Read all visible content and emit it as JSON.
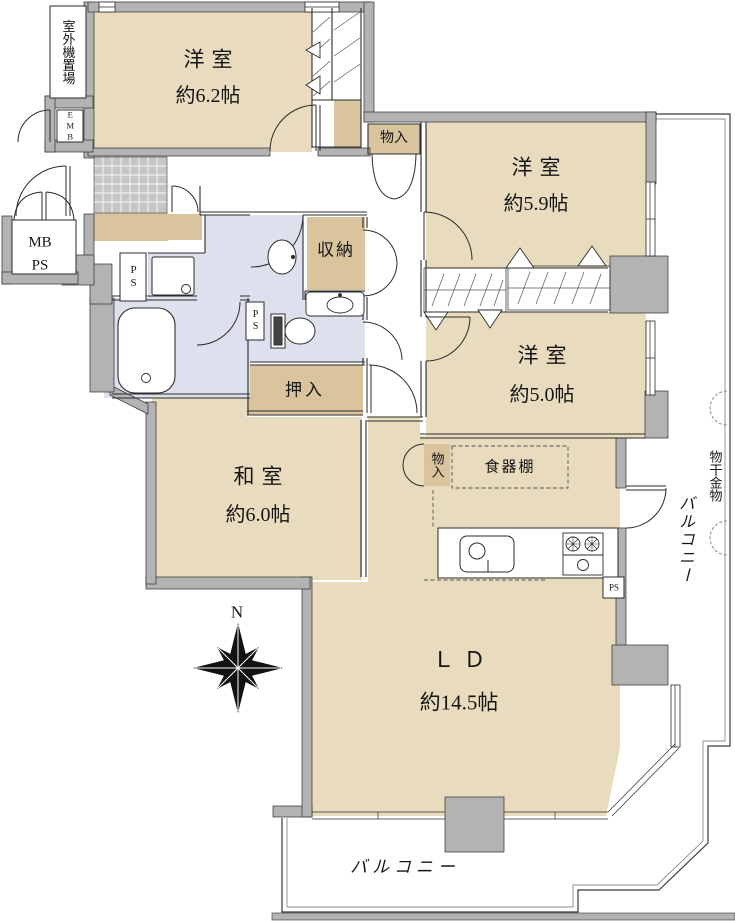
{
  "colors": {
    "room_tan": "#e9dcbe",
    "closet_tan": "#d9c49e",
    "wet_blue": "#dde1ee",
    "wall_gray": "#b3b3b3",
    "tile_gray": "#c6c6c6",
    "line": "#2b2b2b"
  },
  "compass": {
    "north_label": "N"
  },
  "rooms": {
    "western_6_2": {
      "name": "洋室",
      "size": "約6.2帖"
    },
    "western_5_9": {
      "name": "洋室",
      "size": "約5.9帖"
    },
    "western_5_0": {
      "name": "洋室",
      "size": "約5.0帖"
    },
    "japanese_6_0": {
      "name": "和室",
      "size": "約6.0帖"
    },
    "living_dining": {
      "name": "ＬＤ",
      "size": "約14.5帖"
    }
  },
  "storage": {
    "shuno": "収納",
    "oshiire": "押入",
    "monoiri_hall": "物入",
    "monoiri_kitchen": "物入",
    "cupboard": "食器棚"
  },
  "exterior": {
    "balcony_south": "バルコニー",
    "balcony_east": "バルコニー",
    "laundry_hardware": "物干金物",
    "outdoor_unit_space": "室外機置場"
  },
  "utility": {
    "mb": "MB",
    "ps": "PS",
    "emb": "EMB"
  }
}
